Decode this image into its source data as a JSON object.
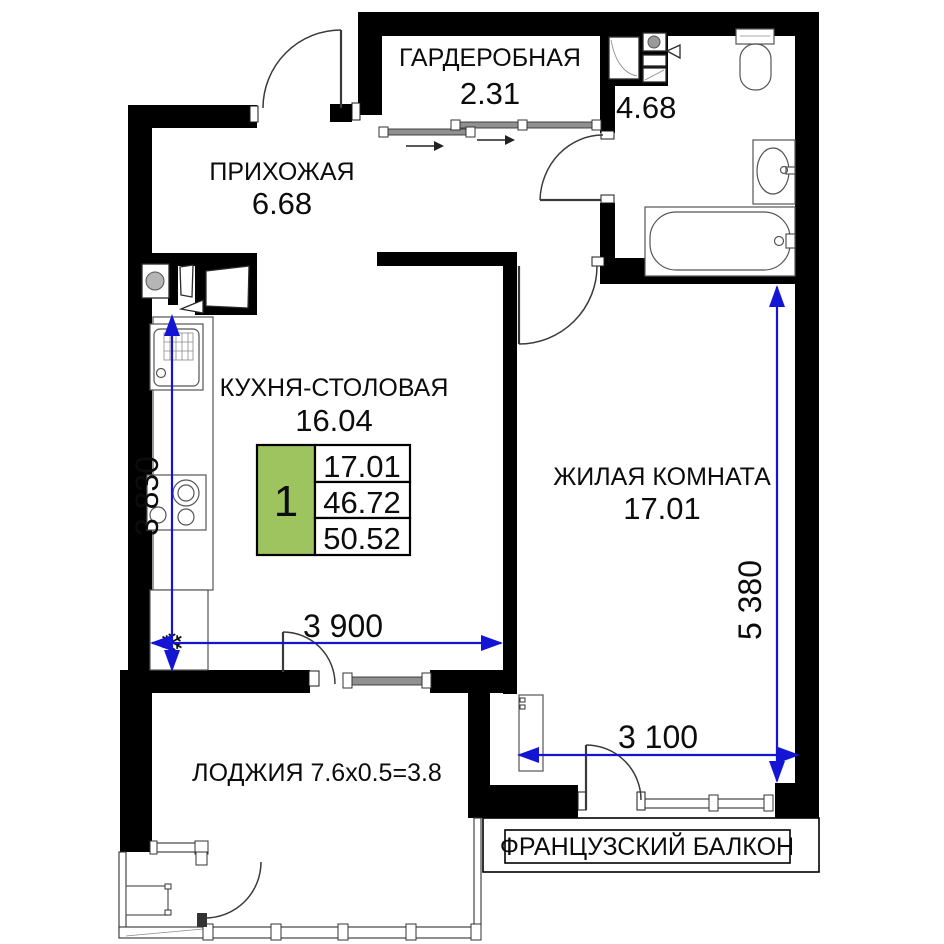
{
  "plan": {
    "rooms": {
      "wardrobe": {
        "name": "ГАРДЕРОБНАЯ",
        "area": "2.31"
      },
      "bathroom": {
        "area": "4.68"
      },
      "hallway": {
        "name": "ПРИХОЖАЯ",
        "area": "6.68"
      },
      "kitchen": {
        "name": "КУХНЯ-СТОЛОВАЯ",
        "area": "16.04"
      },
      "living": {
        "name": "ЖИЛАЯ КОМНАТА",
        "area": "17.01"
      },
      "loggia": {
        "name": "ЛОДЖИЯ 7.6х0.5=3.8"
      },
      "french_balcony": {
        "name": "ФРАНЦУЗСКИЙ БАЛКОН"
      }
    },
    "legend": {
      "rooms": "1",
      "living_area": "17.01",
      "area_without_balcony": "46.72",
      "total_area": "50.52"
    },
    "dimensions": {
      "kitchen_width": "3 900",
      "kitchen_depth": "3 830",
      "living_depth": "5 380",
      "living_width": "3 100"
    },
    "icons": {
      "snowflake": "❄"
    },
    "colors": {
      "wall": "#000000",
      "dimension_blue": "#1414d4",
      "legend_green": "#9dc45f",
      "window_gray": "#909090"
    }
  }
}
